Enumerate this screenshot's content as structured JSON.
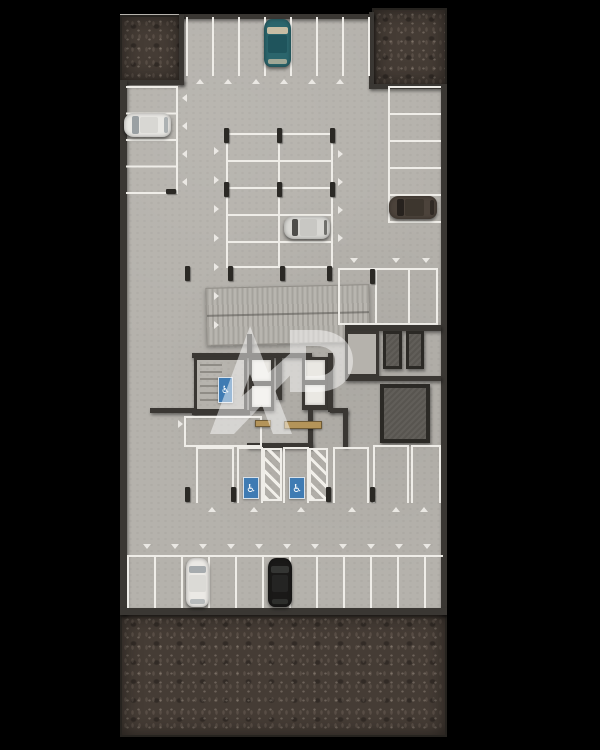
{
  "meta": {
    "title": "Underground parking garage floor plan — top-down architectural render"
  },
  "colors": {
    "background": "#000000",
    "floor": "#b5b2ac",
    "soil": "#453c35",
    "wall": "#3a3733",
    "wall_dark": "#2b2925",
    "line": "#efede8",
    "accessible_blue": "#3f7bb3",
    "storage_floor": "#585550",
    "ramp_rib_dark": "#a5a29c",
    "ramp_rib_light": "#b8b5af",
    "bench_wood": "#b49459",
    "stair_tread": "#8f8c86",
    "elevator_floor": "#eae8e3"
  },
  "icons": {
    "wheelchair_glyph": "♿"
  },
  "watermark": {
    "text": "AP"
  },
  "plan": {
    "parking_zones": [
      {
        "id": "top-row",
        "orientation": "vertical",
        "spaces": 7
      },
      {
        "id": "left-column",
        "orientation": "horizontal",
        "spaces": 4
      },
      {
        "id": "right-column",
        "orientation": "horizontal",
        "spaces": 5
      },
      {
        "id": "center-grid",
        "orientation": "horizontal",
        "spaces": 10
      },
      {
        "id": "right-middle",
        "orientation": "vertical",
        "spaces": 3
      },
      {
        "id": "lower-middle-row",
        "orientation": "vertical",
        "spaces": 6,
        "accessible_spaces": 2,
        "hatched_buffers": 2
      },
      {
        "id": "bottom-row",
        "orientation": "vertical",
        "spaces": 11
      }
    ],
    "cars": [
      {
        "id": "car-teal",
        "zone": "top-row",
        "color_name": "teal",
        "hex": "#2b656c",
        "orientation": "vertical"
      },
      {
        "id": "car-white-left",
        "zone": "left-column",
        "color_name": "white",
        "hex": "#e8e7e3",
        "orientation": "horizontal"
      },
      {
        "id": "car-silver",
        "zone": "center-grid",
        "color_name": "silver",
        "hex": "#d8d7d3",
        "orientation": "horizontal"
      },
      {
        "id": "car-brown-right",
        "zone": "right-column",
        "color_name": "dark-brown",
        "hex": "#4c433b",
        "orientation": "horizontal"
      },
      {
        "id": "car-white-bottom",
        "zone": "bottom-row",
        "color_name": "white",
        "hex": "#ebe9e5",
        "orientation": "vertical"
      },
      {
        "id": "car-black-bottom",
        "zone": "bottom-row",
        "color_name": "black",
        "hex": "#1a1918",
        "orientation": "vertical"
      }
    ],
    "core": {
      "stairwell": {
        "treads": true,
        "accessible_lift_mat": true
      },
      "elevator_shafts": 4,
      "benches": 2
    },
    "storage_rooms": 4,
    "ramp": {
      "surface": "ribbed"
    },
    "soil_areas": [
      "top-left",
      "top-right",
      "bottom"
    ]
  }
}
